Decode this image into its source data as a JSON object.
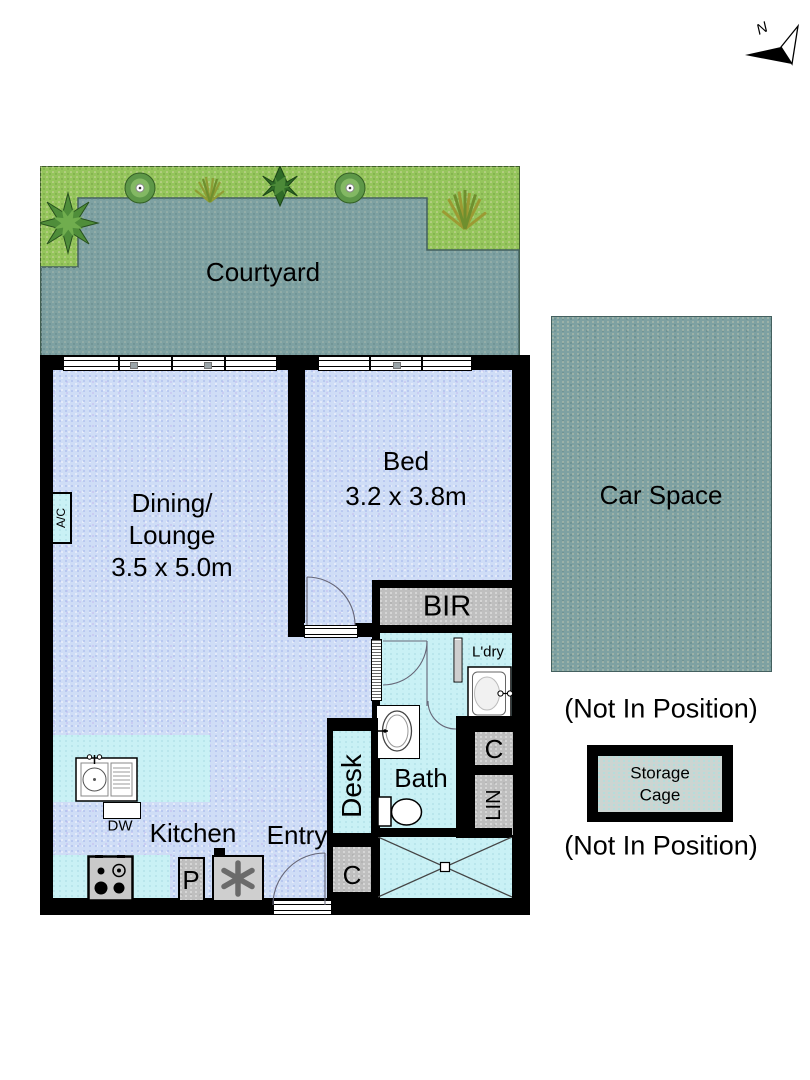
{
  "compass": {
    "north_label": "N"
  },
  "site": {
    "courtyard": {
      "label": "Courtyard"
    },
    "car_space": {
      "label": "Car Space",
      "note": "(Not In Position)"
    },
    "storage_cage": {
      "label_line1": "Storage",
      "label_line2": "Cage",
      "note": "(Not In Position)"
    }
  },
  "apartment": {
    "dining_lounge": {
      "name_line1": "Dining/",
      "name_line2": "Lounge",
      "dimensions": "3.5 x 5.0m"
    },
    "bedroom": {
      "name": "Bed",
      "dimensions": "3.2 x 3.8m"
    },
    "bir": {
      "label": "BIR"
    },
    "laundry": {
      "label": "L'dry"
    },
    "bath": {
      "label": "Bath"
    },
    "desk": {
      "label": "Desk"
    },
    "kitchen": {
      "label": "Kitchen",
      "dishwasher": "DW"
    },
    "entry": {
      "label": "Entry"
    },
    "pantry": {
      "label": "P"
    },
    "cupboard_entry": {
      "label": "C"
    },
    "cupboard_bath": {
      "label": "C"
    },
    "linen": {
      "label": "LIN"
    },
    "air_conditioner": {
      "label": "A/C"
    }
  },
  "colors": {
    "wall": "#000000",
    "floor": "#cfddf6",
    "wet_area": "#c9f1f5",
    "paving_teal": "#7ea1a2",
    "grass_green": "#95c55c",
    "joinery_grey": "#bfbfbf"
  }
}
